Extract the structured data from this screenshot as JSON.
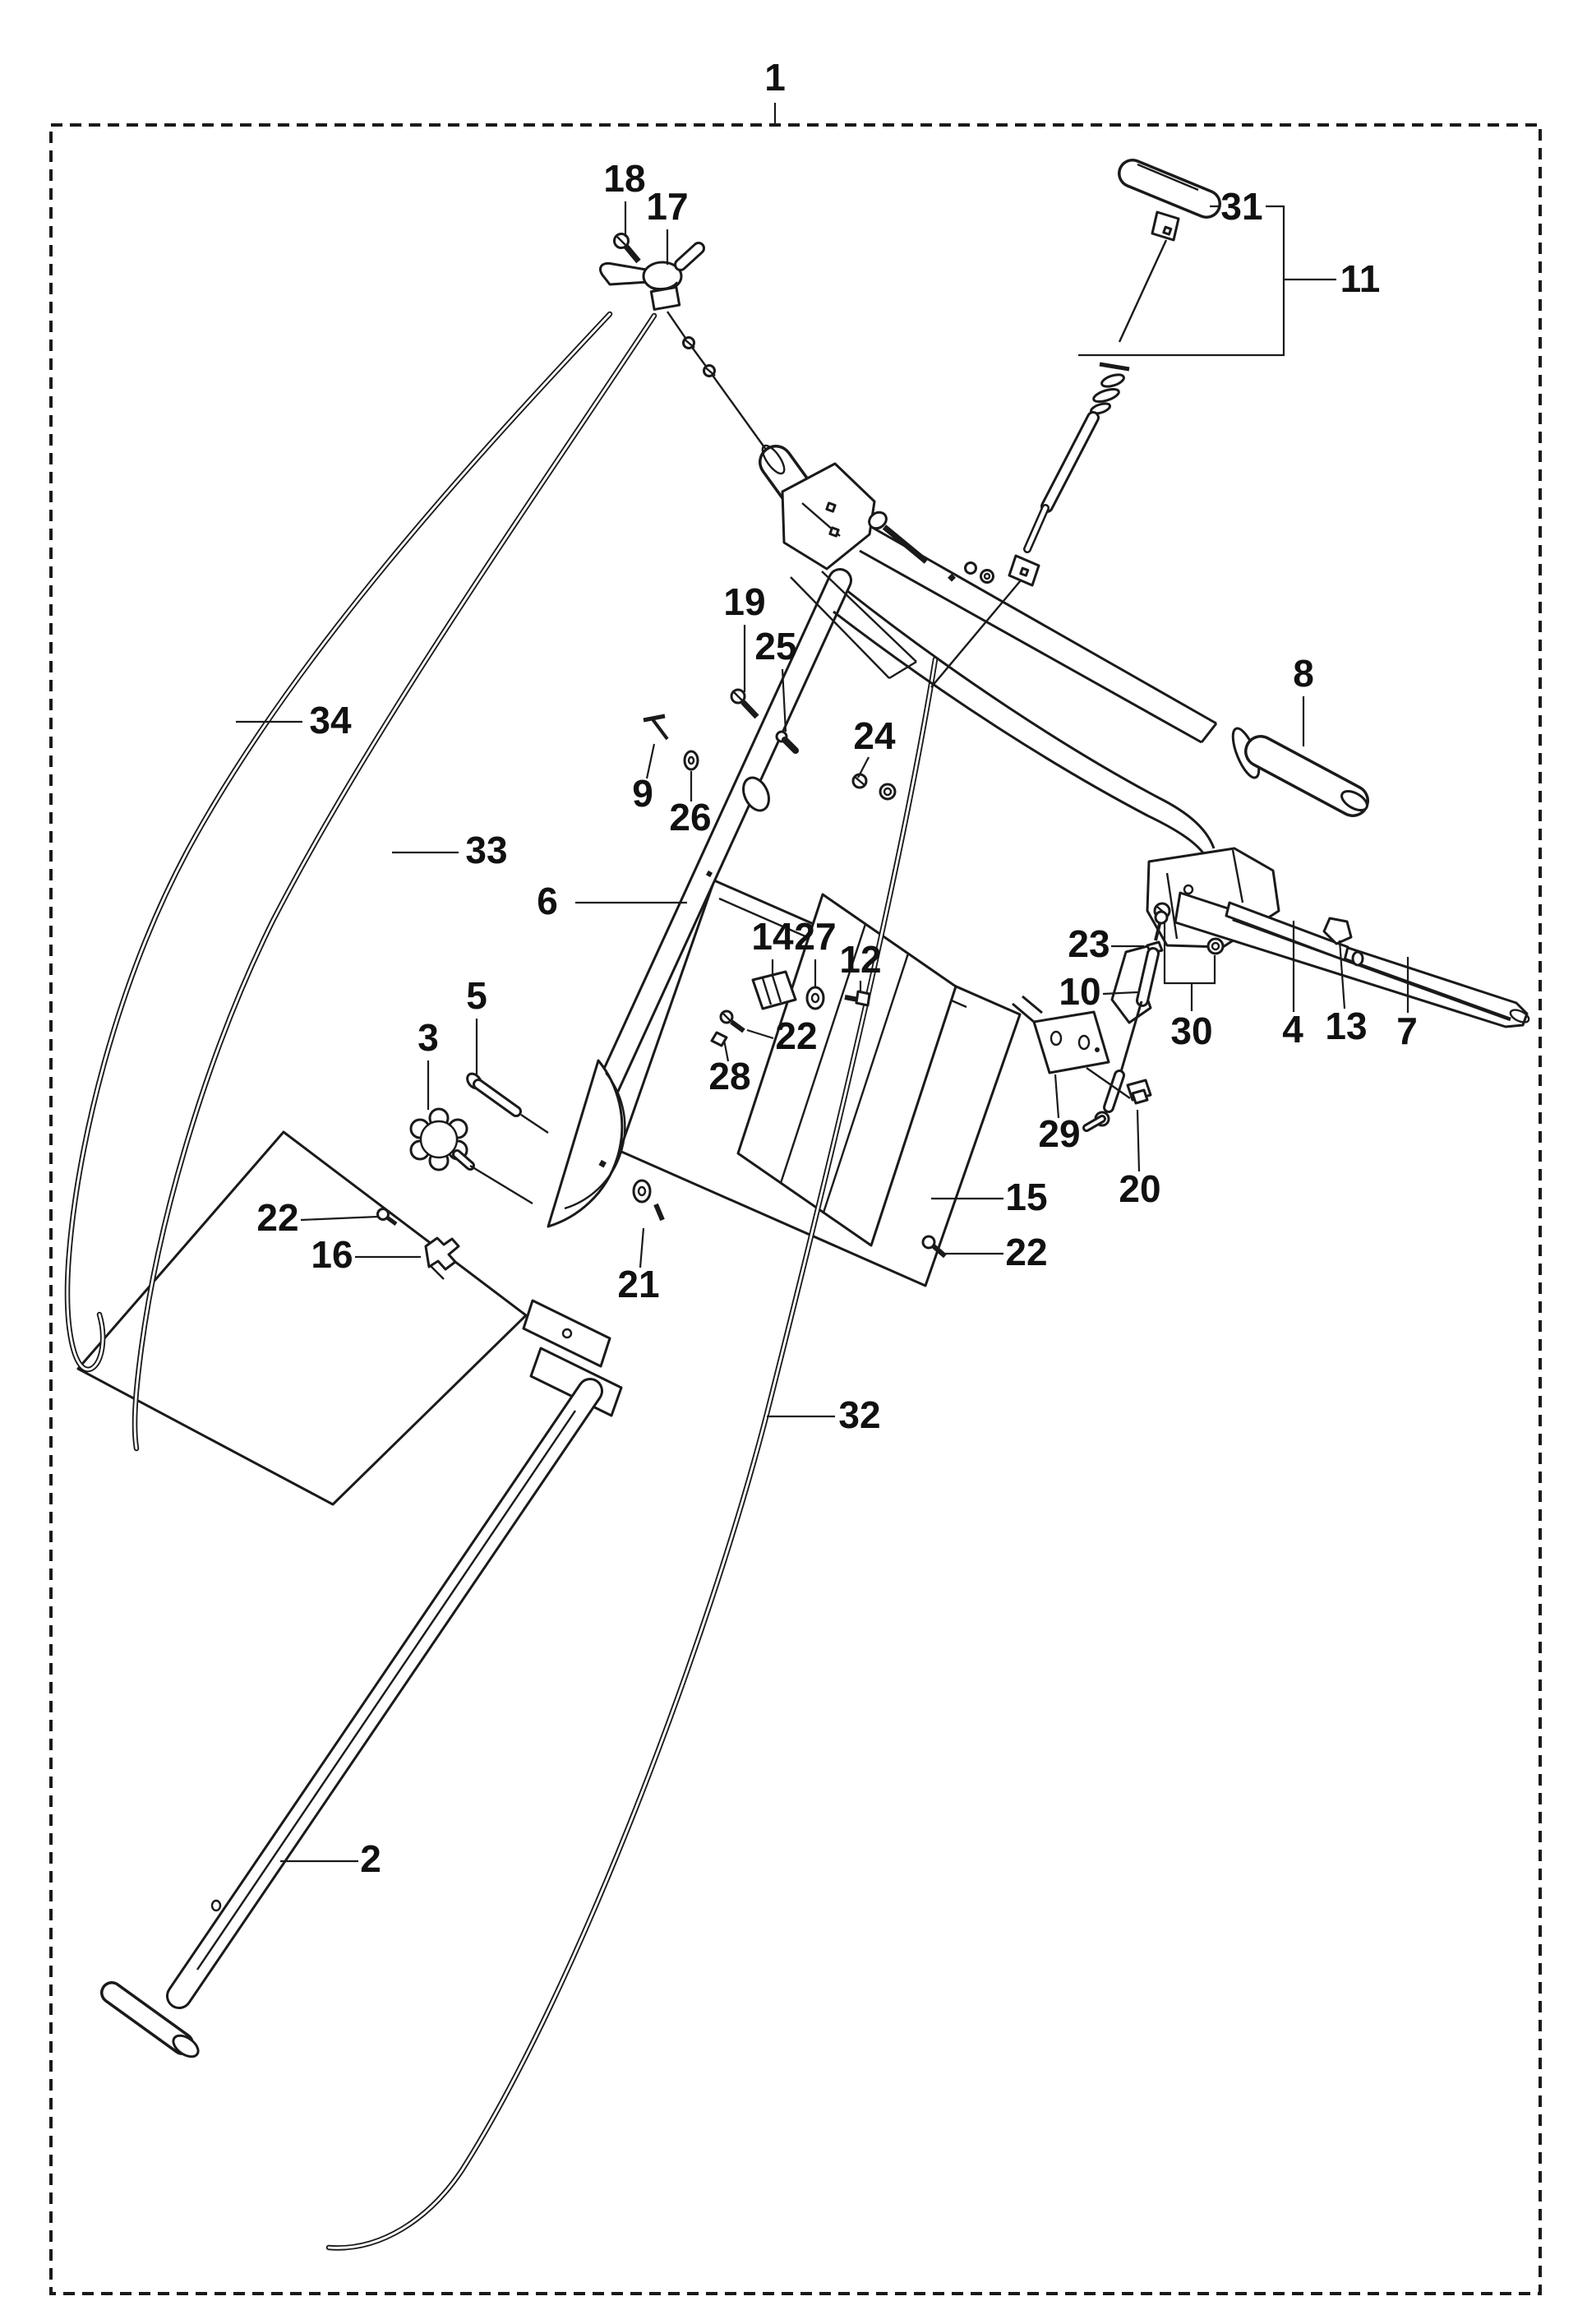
{
  "page": {
    "background": "#ffffff",
    "ink_color": "#1a1a1a",
    "border_style": "dashed"
  },
  "diagram": {
    "type": "exploded-parts-diagram",
    "assembly_callout": "1",
    "callouts": [
      {
        "label": "1"
      },
      {
        "label": "18"
      },
      {
        "label": "17"
      },
      {
        "label": "31"
      },
      {
        "label": "11"
      },
      {
        "label": "8"
      },
      {
        "label": "19"
      },
      {
        "label": "25"
      },
      {
        "label": "9"
      },
      {
        "label": "26"
      },
      {
        "label": "24"
      },
      {
        "label": "6"
      },
      {
        "label": "33"
      },
      {
        "label": "34"
      },
      {
        "label": "14"
      },
      {
        "label": "27"
      },
      {
        "label": "12"
      },
      {
        "label": "22"
      },
      {
        "label": "28"
      },
      {
        "label": "23"
      },
      {
        "label": "10"
      },
      {
        "label": "30"
      },
      {
        "label": "29"
      },
      {
        "label": "20"
      },
      {
        "label": "15"
      },
      {
        "label": "22"
      },
      {
        "label": "5"
      },
      {
        "label": "3"
      },
      {
        "label": "22"
      },
      {
        "label": "16"
      },
      {
        "label": "21"
      },
      {
        "label": "2"
      },
      {
        "label": "32"
      },
      {
        "label": "4"
      },
      {
        "label": "13"
      },
      {
        "label": "7"
      }
    ]
  }
}
